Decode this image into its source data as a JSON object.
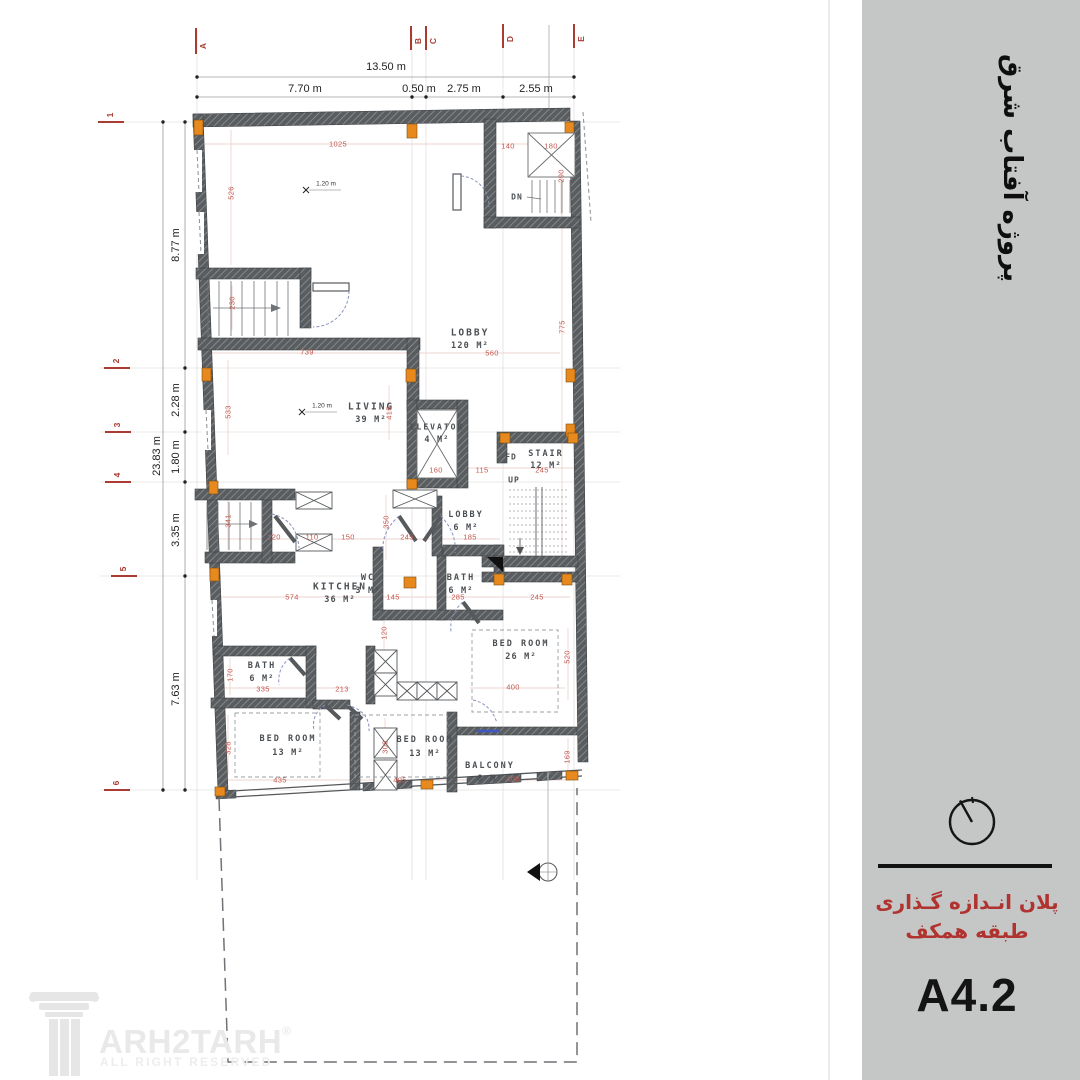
{
  "colors": {
    "sidebar_bg": "#c5c6c6",
    "wall": "#595d60",
    "column_orange": "#e8891e",
    "red_dim": "#c4574e",
    "grid_red": "#a93b32",
    "caption_red": "#b03330",
    "door_arc": "#8992c0"
  },
  "sidebar": {
    "project_title": "پروژه آفتاب شرق",
    "caption_line1": "پلان انـدازه گـذاری",
    "caption_line2": "طبقه همکف",
    "sheet_code": "A4.2"
  },
  "footer": {
    "brand": "ARH2TARH",
    "registered": "®",
    "tagline": "ALL RIGHT RESERVED"
  },
  "grid": {
    "top": [
      "A",
      "B",
      "C",
      "D",
      "E"
    ],
    "left": [
      "1",
      "2",
      "3",
      "4",
      "5",
      "6"
    ]
  },
  "top_dims": {
    "total": "13.50 m",
    "segments": [
      "7.70 m",
      "0.50 m",
      "2.75 m",
      "2.55 m"
    ]
  },
  "left_dims": {
    "total": "23.83 m",
    "segments": [
      "8.77 m",
      "2.28 m",
      "1.80 m",
      "3.35 m",
      "7.63 m"
    ]
  },
  "rooms": {
    "lobby_main": {
      "name": "LOBBY",
      "area": "120 M²"
    },
    "living": {
      "name": "LIVING",
      "area": "39 M²"
    },
    "elevator": {
      "name": "ELEVATOR",
      "area": "4 M²"
    },
    "stair": {
      "name": "STAIR",
      "area": "12 M²"
    },
    "lobby_small": {
      "name": "LOBBY",
      "area": "6 M²"
    },
    "kitchen": {
      "name": "KITCHEN",
      "area": "36 M²"
    },
    "wc": {
      "name": "WC",
      "area": "3 M²"
    },
    "bath_right": {
      "name": "BATH",
      "area": "6 M²"
    },
    "bedroom_26": {
      "name": "BED ROOM",
      "area": "26 M²"
    },
    "bath_left": {
      "name": "BATH",
      "area": "6 M²"
    },
    "bedroom_13_left": {
      "name": "BED ROOM",
      "area": "13 M²"
    },
    "bedroom_13_right": {
      "name": "BED ROOM",
      "area": "13 M²"
    },
    "balcony": {
      "name": "BALCONY",
      "area": "8 M²"
    }
  },
  "annotations": {
    "dn": "DN",
    "up": "UP",
    "fd": "FD",
    "spot_level": "1.20 m"
  },
  "red_dims": [
    "1025",
    "526",
    "140",
    "180",
    "290",
    "775",
    "739",
    "533",
    "415",
    "230",
    "560",
    "160",
    "115",
    "245",
    "341",
    "120",
    "110",
    "150",
    "245",
    "185",
    "350",
    "574",
    "145",
    "285",
    "245",
    "120",
    "335",
    "170",
    "213",
    "400",
    "520",
    "435",
    "405",
    "400",
    "328",
    "308",
    "169"
  ]
}
